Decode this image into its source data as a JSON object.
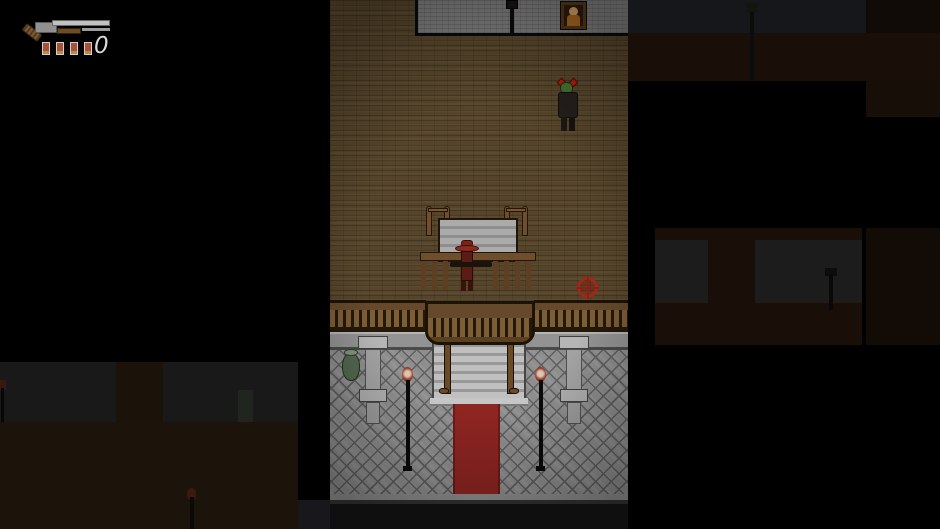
{
  "hud": {
    "weapon_icon": "pump-shotgun-icon",
    "shell_icon": "shotgun-shell-icon",
    "shell_count": 4,
    "ammo_count": "0"
  },
  "entities": {
    "zombie": {
      "label": "zombie-enemy",
      "health_icons": 2,
      "head_color": "#45722e"
    },
    "player": {
      "label": "player-cowboy",
      "hat_color": "#8e2a1c",
      "weapon": "rifle"
    },
    "objective_marker": {
      "label": "crosshair-marker",
      "color": "#a02818"
    }
  },
  "props": [
    "dining-table",
    "chairs",
    "balcony-railing",
    "staircase",
    "red-carpet",
    "standing-torches",
    "green-vase",
    "stone-pillars",
    "wall-lamp",
    "portrait-painting"
  ],
  "palette": {
    "background": "#000000",
    "wood_floor": "#56452a",
    "stone_wall": "#7d7d7d",
    "tile_floor": "#8e8e8e",
    "railing_wood": "#66492a",
    "carpet_red": "#8d2521",
    "stair_gray": "#b9b9b9"
  }
}
